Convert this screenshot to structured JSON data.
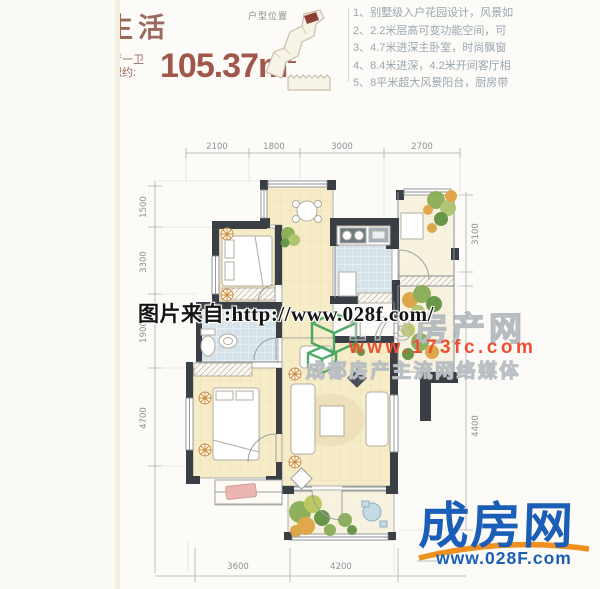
{
  "header": {
    "title": "生活",
    "rooms_line": "厅一卫",
    "area_prefix": "积约:",
    "area_value": "105.37m",
    "area_sup": "2",
    "location_label": "户型位置",
    "features": [
      "1、别墅级入户花园设计，风景如",
      "2、2.2米层高可变功能空间，可",
      "3、4.7米进深主卧室，时尚飘窗",
      "4、8.4米进深，4.2米开间客厅相",
      "5、8平米超大风景阳台，厨房带"
    ]
  },
  "floorplan": {
    "dims_top": [
      "2100",
      "1800",
      "3000",
      "2700"
    ],
    "dims_left": [
      "1500",
      "3300",
      "1900",
      "4700"
    ],
    "dims_right": [
      "3100",
      "4400"
    ],
    "dims_bottom": [
      "3600",
      "4200"
    ]
  },
  "watermarks": {
    "photo_source": "图片来自:http://www.028f.com/",
    "brand_name": "173房产网",
    "brand_url": "www.173fc.com",
    "brand_slogan": "成都房产主流网络媒体"
  },
  "footer_logo": {
    "name": "成房网",
    "url": "www.028F.com"
  },
  "colors": {
    "accent_brown": "#9a6a5c",
    "area_red": "#a1564a",
    "wall_dark": "#3a3f45",
    "brand_green": "#2f9e51",
    "brand_red": "#ee4f33",
    "logo_blue": "#1a5eb8",
    "logo_orange": "#ef8f1d"
  }
}
